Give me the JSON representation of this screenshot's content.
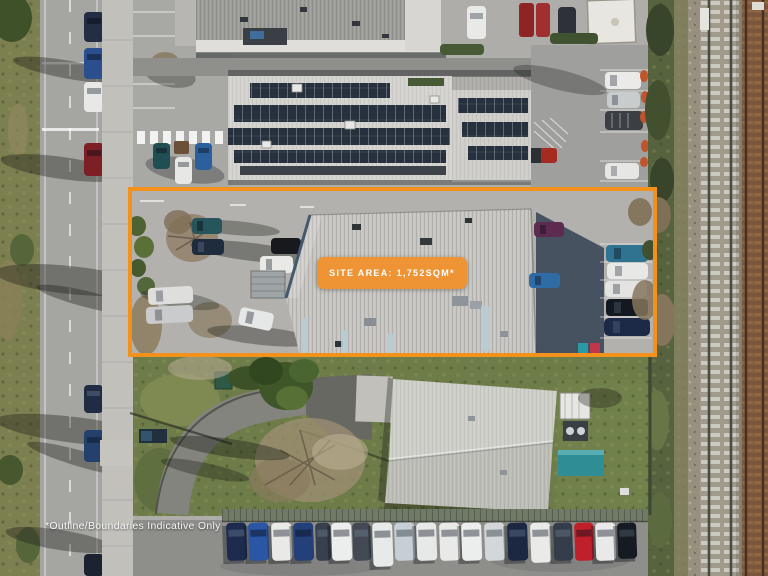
{
  "annotations": {
    "site_area": "SITE AREA: 1,752SQM*",
    "disclaimer": "*Outline/Boundaries Indicative Only"
  },
  "colors": {
    "outline_orange": "#F2921C",
    "badge_orange": "#EE9434",
    "annotation_text": "#FFFFFF"
  }
}
